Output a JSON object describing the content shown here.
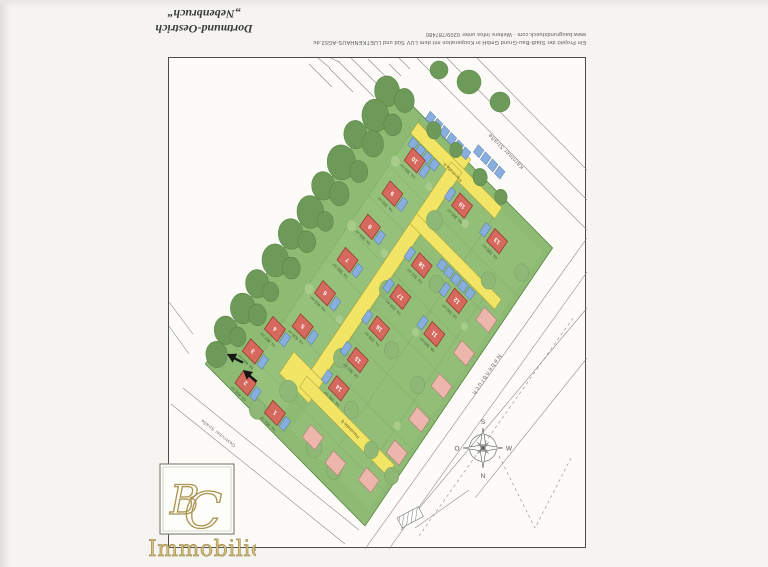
{
  "header": {
    "project_title_line1": "Dortmund-Oestrich",
    "project_title_line2": "„Nebenbruch“",
    "info_line1": "Ein Projekt der Stadt-Bau-Grund GmbH in Kooperation mit dem LUV Süd und LUETKENHAUS-AG52.de",
    "info_line2": "www.baugrundstueck.com · Weitere Infos unter 0209/787480"
  },
  "plan": {
    "streets": {
      "ne": "Kärntner Straße",
      "se": "Nebenbruch",
      "sw": "Oestricher Straße",
      "internal_a": "Planstraße A",
      "internal_b": "Planstraße B"
    },
    "compass": {
      "top": "S",
      "bottom": "N",
      "left": "O",
      "right": "W"
    },
    "colors": {
      "lawn": "#8dbb73",
      "lawn_light": "#9ac47f",
      "tree": "#6d9a58",
      "tree_stroke": "#55803f",
      "road": "#f2e565",
      "road_stroke": "#a99b35",
      "house": "#d6695d",
      "house_stroke": "#93392e",
      "house_existing": "#edb6ac",
      "house_existing_stroke": "#b07c72",
      "garage": "#87aede",
      "garage_stroke": "#3f6190"
    },
    "houses": [
      {
        "no": "10",
        "area": "ca. 350 m²",
        "u": 52,
        "v": 30
      },
      {
        "no": "9",
        "area": "ca. 355 m²",
        "u": 52,
        "v": 70
      },
      {
        "no": "8",
        "area": "ca. 368 m²",
        "u": 52,
        "v": 110
      },
      {
        "no": "7",
        "area": "ca. 380 m²",
        "u": 52,
        "v": 150
      },
      {
        "no": "6",
        "area": "ca. 413 m²",
        "u": 52,
        "v": 190
      },
      {
        "no": "5",
        "area": "ca. 428 m²",
        "u": 52,
        "v": 230
      },
      {
        "no": "4",
        "area": "ca. 457 m²",
        "u": 30,
        "v": 252
      },
      {
        "no": "3",
        "area": "ca. 440 m²",
        "u": 24,
        "v": 284
      },
      {
        "no": "2",
        "area": "ca. 455 m²",
        "u": 36,
        "v": 312
      },
      {
        "no": "1",
        "area": "ca. 450 m²",
        "u": 78,
        "v": 312
      },
      {
        "no": "19",
        "area": "ca. 305 m²",
        "u": 118,
        "v": 28
      },
      {
        "no": "18",
        "area": "ca. 312 m²",
        "u": 118,
        "v": 100
      },
      {
        "no": "17",
        "area": "ca. 318 m²",
        "u": 118,
        "v": 138
      },
      {
        "no": "16",
        "area": "ca. 330 m²",
        "u": 118,
        "v": 176
      },
      {
        "no": "15",
        "area": "ca. 362 m²",
        "u": 118,
        "v": 214
      },
      {
        "no": "14",
        "area": "ca. 395 m²",
        "u": 118,
        "v": 248
      },
      {
        "no": "13",
        "area": "ca. 338 m²",
        "u": 168,
        "v": 28
      },
      {
        "no": "12",
        "area": "ca. 340 m²",
        "u": 168,
        "v": 100
      },
      {
        "no": "11",
        "area": "ca. 345 m²",
        "u": 168,
        "v": 140
      }
    ],
    "existing_houses": [
      {
        "u": 204,
        "v": 92
      },
      {
        "u": 204,
        "v": 132
      },
      {
        "u": 204,
        "v": 172
      },
      {
        "u": 204,
        "v": 212
      },
      {
        "u": 204,
        "v": 252
      },
      {
        "u": 196,
        "v": 292
      },
      {
        "u": 158,
        "v": 304
      },
      {
        "u": 124,
        "v": 302
      }
    ]
  },
  "logo": {
    "monogram_b": "B",
    "monogram_c": "C",
    "text": "Immobilien"
  }
}
